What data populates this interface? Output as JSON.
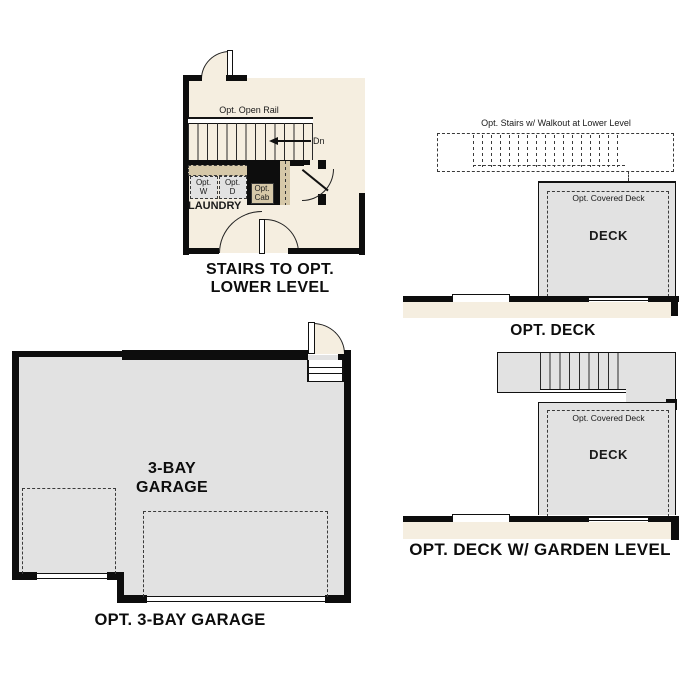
{
  "colors": {
    "beige": "#f5eee0",
    "tan": "#d6c8a8",
    "gray": "#e2e2e2",
    "wall": "#0d0d0d"
  },
  "stairs_plan": {
    "title_line1": "STAIRS TO OPT.",
    "title_line2": "LOWER LEVEL",
    "open_rail": "Opt. Open Rail",
    "dn": "Dn",
    "opt_w_line1": "Opt.",
    "opt_w_line2": "W",
    "opt_d_line1": "Opt.",
    "opt_d_line2": "D",
    "laundry": "LAUNDRY",
    "opt_cab_line1": "Opt.",
    "opt_cab_line2": "Cab"
  },
  "deck_plan": {
    "title": "OPT. DECK",
    "stairs_note": "Opt. Stairs w/ Walkout at Lower Level",
    "covered_deck": "Opt. Covered Deck",
    "deck": "DECK"
  },
  "garage_plan": {
    "title": "OPT. 3-BAY GARAGE",
    "label_line1": "3-BAY",
    "label_line2": "GARAGE"
  },
  "garden_deck_plan": {
    "title": "OPT. DECK W/ GARDEN LEVEL",
    "covered_deck": "Opt. Covered Deck",
    "deck": "DECK"
  }
}
